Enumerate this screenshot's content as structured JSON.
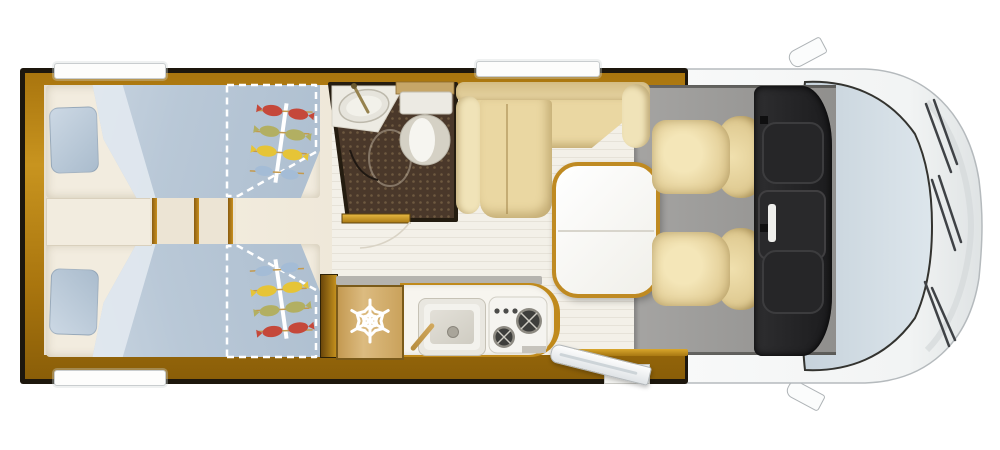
{
  "page": {
    "background": "#ffffff",
    "description": "Top-down floor plan of a motorhome (campervan) with rear twin beds, bathroom, kitchenette, L-shaped dinette and driver cab"
  },
  "regions": {
    "bedroom": {
      "title": "Rear bedroom with two single beds",
      "bed_count": 2,
      "features": [
        "pillows",
        "blue duvets",
        "fish-print bedspread art",
        "dashed fold-out bed extensions",
        "center step with wooden slats"
      ]
    },
    "bathroom": {
      "title": "Bathroom with washbasin, shower floor and toilet",
      "features": [
        "oval washbasin",
        "faucet",
        "shower tray outline",
        "toilet with cistern",
        "door with swing arc"
      ]
    },
    "kitchen": {
      "title": "Kitchenette with refrigerator, sink and two-burner hob",
      "features": [
        "fridge with snowflake icon",
        "rectangular sink with faucet",
        "hob with 2 burners and 3 knobs"
      ]
    },
    "dinette": {
      "title": "L-shaped lounge bench with pedestal table",
      "features": [
        "L-shaped beige bench",
        "two armrests",
        "white table with wooden rim, split top"
      ]
    },
    "cab": {
      "title": "Driver cab with two swivelled captain seats",
      "features": [
        "two beige swivel seats facing rear",
        "dark dashboard with instrument clusters",
        "windshield with three wipers",
        "two exterior mirrors"
      ]
    },
    "entry": {
      "title": "Entry door shown swung open on lower side wall"
    }
  },
  "icons": {
    "fridge_icon": "snowflake-icon",
    "bed_art": "fish-skewer-print"
  },
  "palette": {
    "wall_gold": "#c8941f",
    "outline_dark": "#1d170d",
    "bed_blue": "#b9c8d7",
    "upholstery_beige": "#ead7a2",
    "cab_floor_gray": "#9b9a98",
    "bathroom_floor_brown": "#4a382a",
    "glass_blue": "#ccd7df",
    "body_white": "#f8f9f9",
    "table_rim_gold": "#bf8a22",
    "fish_colors": [
      "#c5483a",
      "#b2af62",
      "#e6c437",
      "#a4bcd6"
    ]
  }
}
